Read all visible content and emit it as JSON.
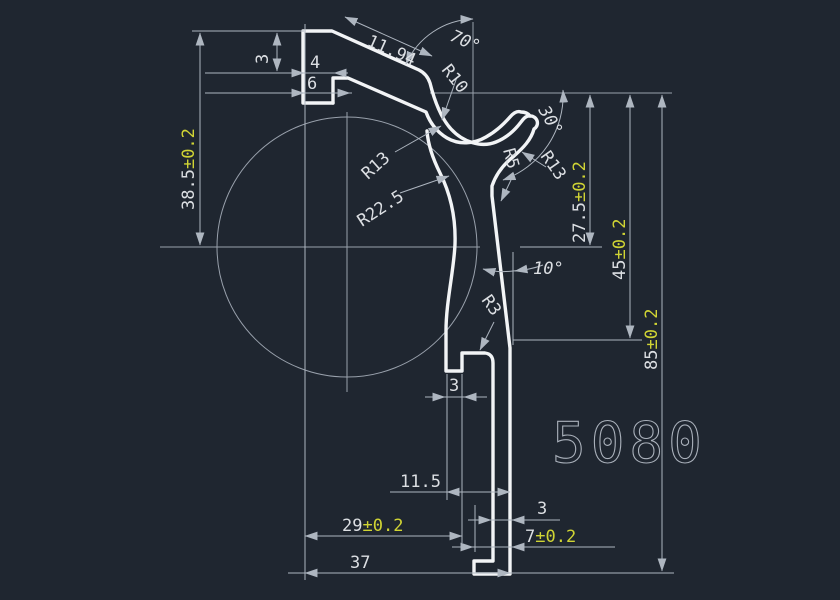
{
  "colors": {
    "background": "#1f2630",
    "line": "#f2f4f6",
    "dim": "#aeb6c0",
    "construction": "#99a1ac",
    "text": "#dcdfe3",
    "tolerance": "#d0d434",
    "part_label": "#aab1bb"
  },
  "part": {
    "number": "5080"
  },
  "dims": {
    "slope_length": "11.94",
    "slope_angle": "70°",
    "top_thickness": "3",
    "hook_dim_4": "4",
    "hook_dim_6": "6",
    "height_38_5": {
      "value": "38.5",
      "tol": "±0.2"
    },
    "radius_cup": "R10",
    "lip_angle": "30°",
    "radius_cup_outer": "R13",
    "radius_slot": "R5",
    "radius_lip_outer": "R13",
    "radius_stem": "R22.5",
    "height_27_5": {
      "value": "27.5",
      "tol": "±0.2"
    },
    "height_45": {
      "value": "45",
      "tol": "±0.2"
    },
    "height_85": {
      "value": "85",
      "tol": "±0.2"
    },
    "stem_angle": "10°",
    "radius_fillet": "R3",
    "notch_width": "3",
    "offset_11_5": "11.5",
    "width_29": {
      "value": "29",
      "tol": "±0.2"
    },
    "width_37": "37",
    "leg_thickness": "3",
    "foot_width": {
      "value": "7",
      "tol": "±0.2"
    }
  }
}
